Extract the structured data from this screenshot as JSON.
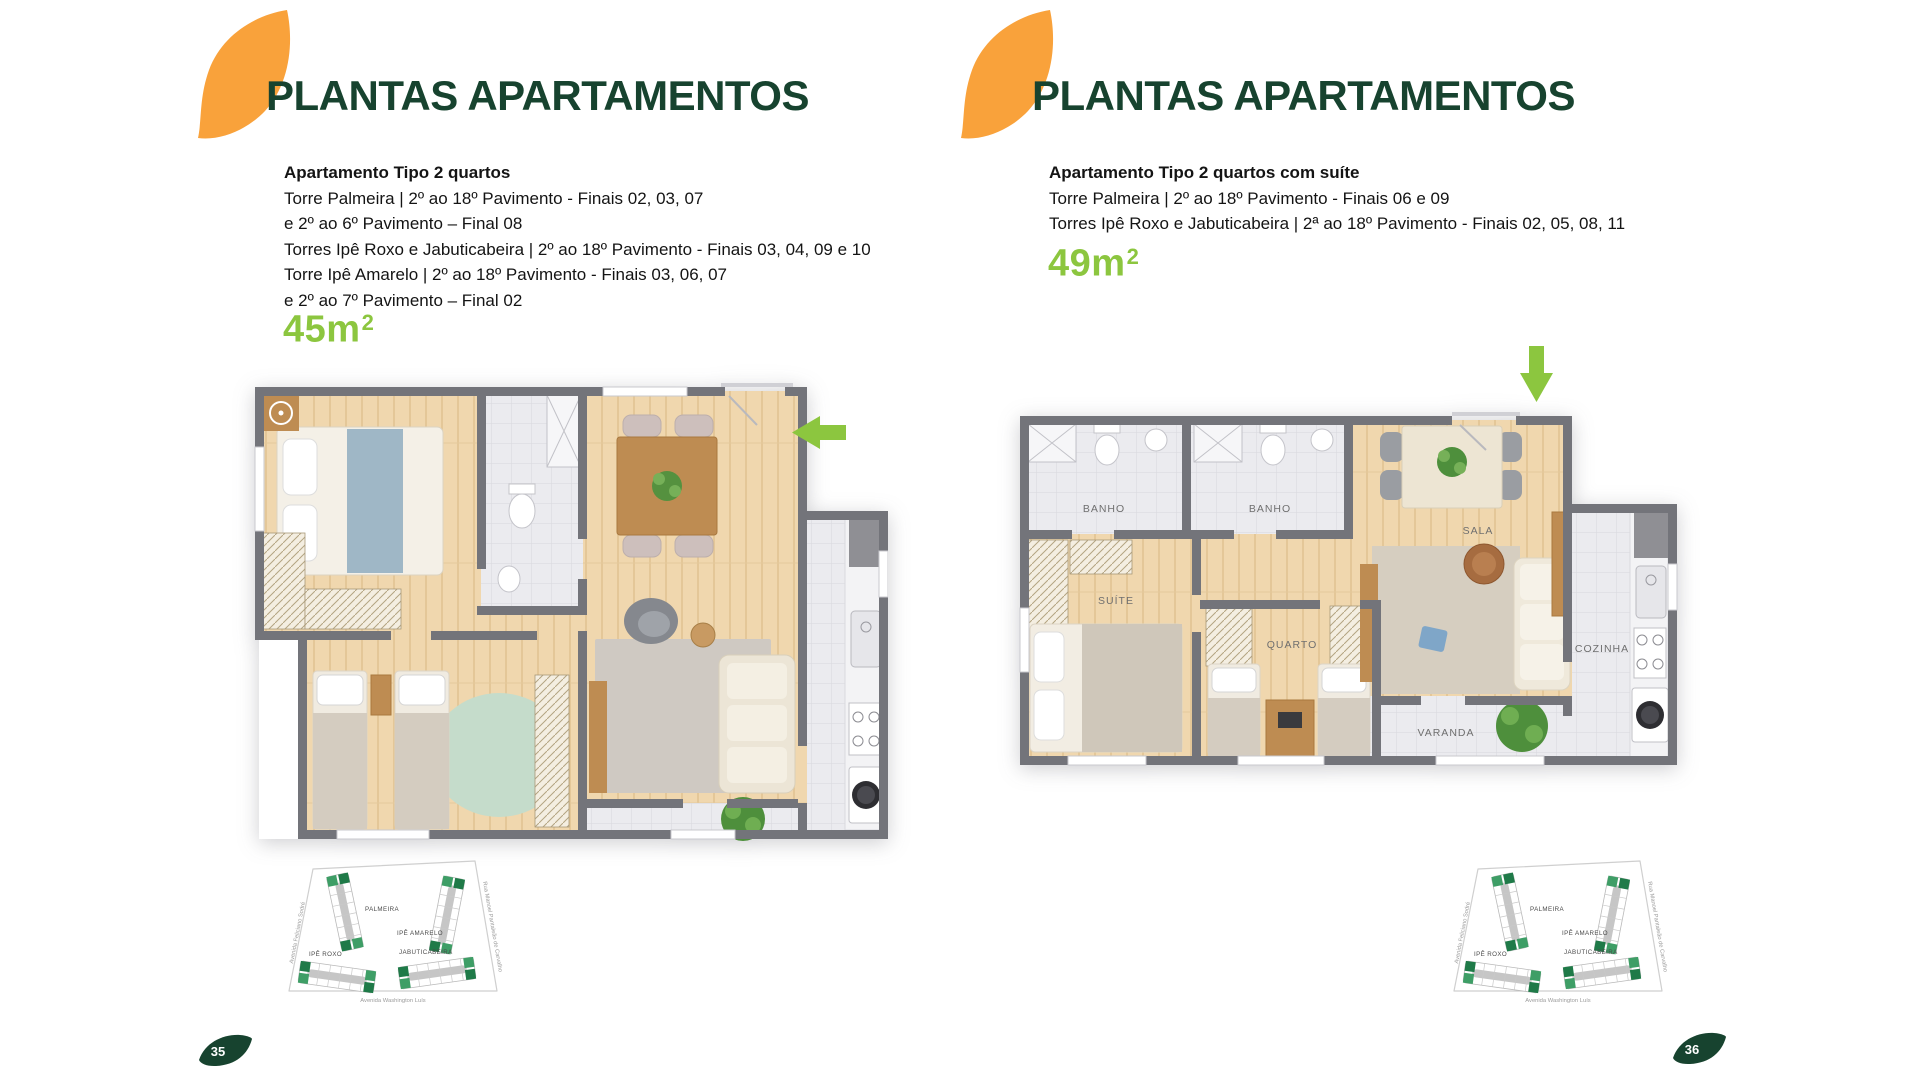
{
  "colors": {
    "orange": "#F9A23B",
    "dark_green": "#17432F",
    "lime": "#8CC63F",
    "wall_gray": "#73747A"
  },
  "panels": [
    {
      "title": "PLANTAS APARTAMENTOS",
      "subtitle": "Apartamento Tipo 2 quartos",
      "lines": [
        "Torre Palmeira | 2º ao 18º Pavimento - Finais 02, 03, 07",
        "e 2º ao 6º Pavimento – Final 08",
        "Torres Ipê Roxo e Jabuticabeira | 2º ao 18º Pavimento - Finais 03, 04, 09 e 10",
        "Torre Ipê Amarelo | 2º ao 18º Pavimento - Finais 03, 06, 07",
        "e 2º ao 7º Pavimento – Final 02"
      ],
      "area_value": "45m",
      "area_sup": "2",
      "page": "35"
    },
    {
      "title": "PLANTAS APARTAMENTOS",
      "subtitle": "Apartamento Tipo 2 quartos com suíte",
      "lines": [
        "Torre Palmeira | 2º ao 18º Pavimento - Finais 06 e 09",
        "Torres Ipê Roxo e Jabuticabeira | 2ª ao 18º Pavimento - Finais 02, 05, 08, 11"
      ],
      "area_value": "49m",
      "area_sup": "2",
      "page": "36"
    }
  ],
  "floorplan_right_labels": {
    "banho1": "BANHO",
    "banho2": "BANHO",
    "sala": "SALA",
    "suite": "SUÍTE",
    "quarto": "QUARTO",
    "cozinha": "COZINHA",
    "varanda": "VARANDA"
  },
  "site_map": {
    "towers": {
      "palmeira": "PALMEIRA",
      "ipe_amarelo": "IPÊ AMARELO",
      "ipe_roxo": "IPÊ ROXO",
      "jabuticabeira": "JABUTICABEIRA"
    },
    "streets": {
      "left": "Avenida Feliciano Sodré",
      "right": "Rua Manoel Pantaleão de Carvalho",
      "bottom": "Avenida Washington Luís"
    }
  }
}
